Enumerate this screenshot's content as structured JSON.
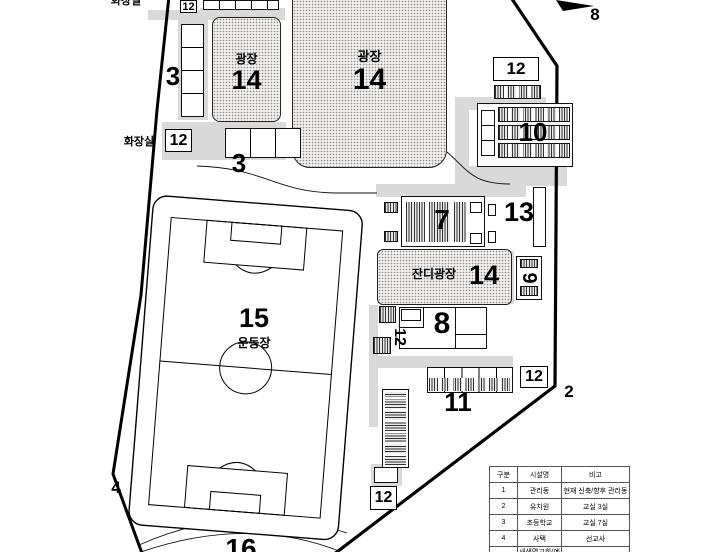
{
  "plan_title": "site-plan-drawing",
  "colors": {
    "line": "#000000",
    "path_gray": "#d9d9d9",
    "stipple_bg": "#f3f2ef",
    "stipple_dot": "#8f8f8f"
  },
  "labels": {
    "toilet_top": "화장실",
    "toilet_left": "화장실",
    "n12_topleft": "12",
    "n12_left": "12",
    "n12_topright": "12",
    "n12_rotated": "12",
    "n12_right": "12",
    "n12_bottom": "12",
    "n3_upper": "3",
    "n3_lower": "3",
    "plaza_small_name": "광장",
    "plaza_small_num": "14",
    "plaza_big_name": "광장",
    "plaza_big_num": "14",
    "lawn_plaza_name": "잔디광장",
    "lawn_plaza_num": "14",
    "n10": "10",
    "n13": "13",
    "n7": "7",
    "n9": "9",
    "n8_building": "8",
    "n8_arrow": "8",
    "n11": "11",
    "n2": "2",
    "n4": "4",
    "n15": "15",
    "field_name": "운동장",
    "n16": "16"
  },
  "legend_table": {
    "headers": [
      "구분",
      "시설명",
      "비고"
    ],
    "rows": [
      [
        "1",
        "관리동",
        "현재 신축/향후 관리동"
      ],
      [
        "2",
        "유치원",
        "교실 3실"
      ],
      [
        "3",
        "초등학교",
        "교실 7실"
      ],
      [
        "4",
        "사택",
        "선교사"
      ],
      [
        "5",
        "새생명교회(예배당)",
        "평상시 겸 다목적홀"
      ]
    ]
  }
}
